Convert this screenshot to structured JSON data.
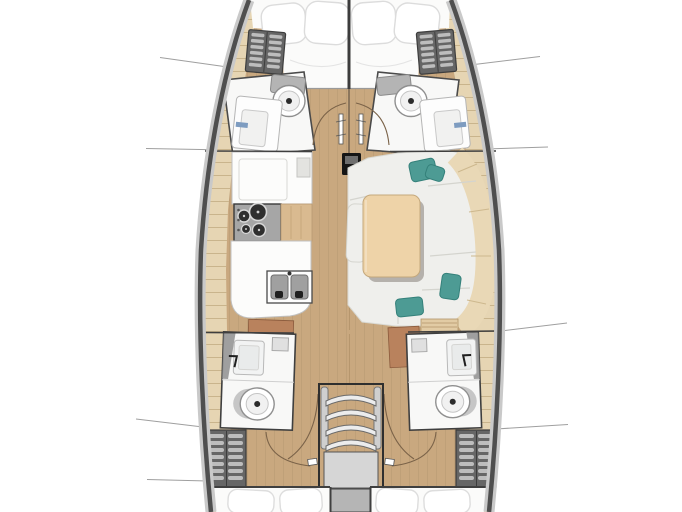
{
  "meta": {
    "title": "Sailing yacht interior deck plan, top view, bow up",
    "diagram_type": "floor-plan",
    "visible_text": ""
  },
  "colors": {
    "floor-wood": "#c9a87f",
    "plank-seam": "#8a6f52",
    "shelf-beige": "#e6d5b3",
    "shelf-line": "#c2ab82",
    "room-white": "#f8f8f7",
    "berth-white": "#fbfbfa",
    "cushion": "#efefec",
    "cushion-seam": "#d4d4ce",
    "backrest-beige": "#e9d8b6",
    "pillow-teal": "#4d9b94",
    "pillow-teal-dark": "#34807a",
    "table-wood": "#eed3a8",
    "table-shadow": "#5f564e",
    "stove-gray": "#a6a6a6",
    "burner-dark": "#2f2f2f",
    "sink-gray": "#a0a0a0",
    "drain-dark": "#1f1f1f",
    "locker-dark": "#666666",
    "locker-slat": "#bdbdbd",
    "stair-tread": "#ececec",
    "stair-platform": "#d6d6d6",
    "mast-black": "#151515",
    "cabinet-brown": "#b9825d",
    "accent-blue": "#7e9cc0",
    "arc-line": "#7a6248",
    "section-line": "#9f9f9f",
    "wall-dark": "#3f3f3f",
    "hull-line": "#4f4f4f",
    "hull-outer": "#c9c9c9"
  },
  "regions": {
    "bow_cabin": {
      "name": "Forward cabin with V-berth and pillows"
    },
    "bow_locker_left": {
      "name": "Forward storage locker, left"
    },
    "bow_locker_right": {
      "name": "Forward storage locker, right"
    },
    "fwd_head_left": {
      "name": "Forward head (toilet + sink), left"
    },
    "fwd_head_right": {
      "name": "Forward head (toilet + sink), right"
    },
    "mast": {
      "name": "Mast at cabin centerline"
    },
    "galley": {
      "name": "Galley with counters, 4-burner stove and double sink"
    },
    "salon": {
      "name": "Salon with settee, dining table, bench and 4 teal pillows"
    },
    "aft_head_left": {
      "name": "Aft head (sink + toilet), left"
    },
    "aft_head_right": {
      "name": "Aft head (sink + toilet), right"
    },
    "companionway": {
      "name": "Companionway stairs, 4 treads with landing"
    },
    "aft_locker_left": {
      "name": "Aft storage locker, left"
    },
    "aft_locker_right": {
      "name": "Aft storage locker, right"
    },
    "aft_cabin_left": {
      "name": "Aft cabin berth with pillows, left"
    },
    "aft_cabin_right": {
      "name": "Aft cabin berth with pillows, right"
    }
  },
  "counts": {
    "steps": 4,
    "stove_burners": 4,
    "teal_pillows": 4,
    "toilets": 4,
    "sinks": 5
  }
}
